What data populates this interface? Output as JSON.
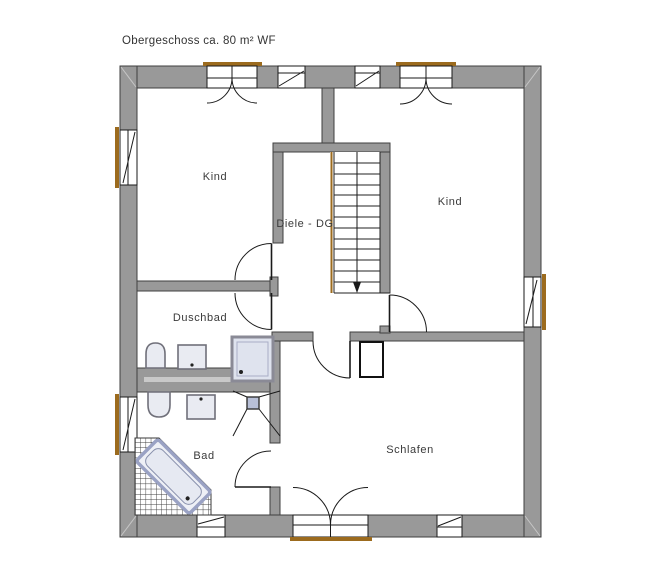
{
  "title": "Obergeschoss ca. 80 m² WF",
  "rooms": {
    "kind_left": {
      "label": "Kind"
    },
    "kind_right": {
      "label": "Kind"
    },
    "diele": {
      "label": "Diele - DG"
    },
    "duschbad": {
      "label": "Duschbad"
    },
    "bad": {
      "label": "Bad"
    },
    "schlafen": {
      "label": "Schlafen"
    }
  },
  "colors": {
    "wall": "#999999",
    "wall_outline": "#3f3f3f",
    "drawing_line": "#1a1a1a",
    "sill_accent": "#9c6b1e",
    "fixture_fill": "#e9ebf2",
    "fixture_stroke": "#70707a",
    "shower_fill": "#dfe3ee",
    "bathtub_stroke": "#9aa2c4",
    "text": "#3a3a3a"
  }
}
